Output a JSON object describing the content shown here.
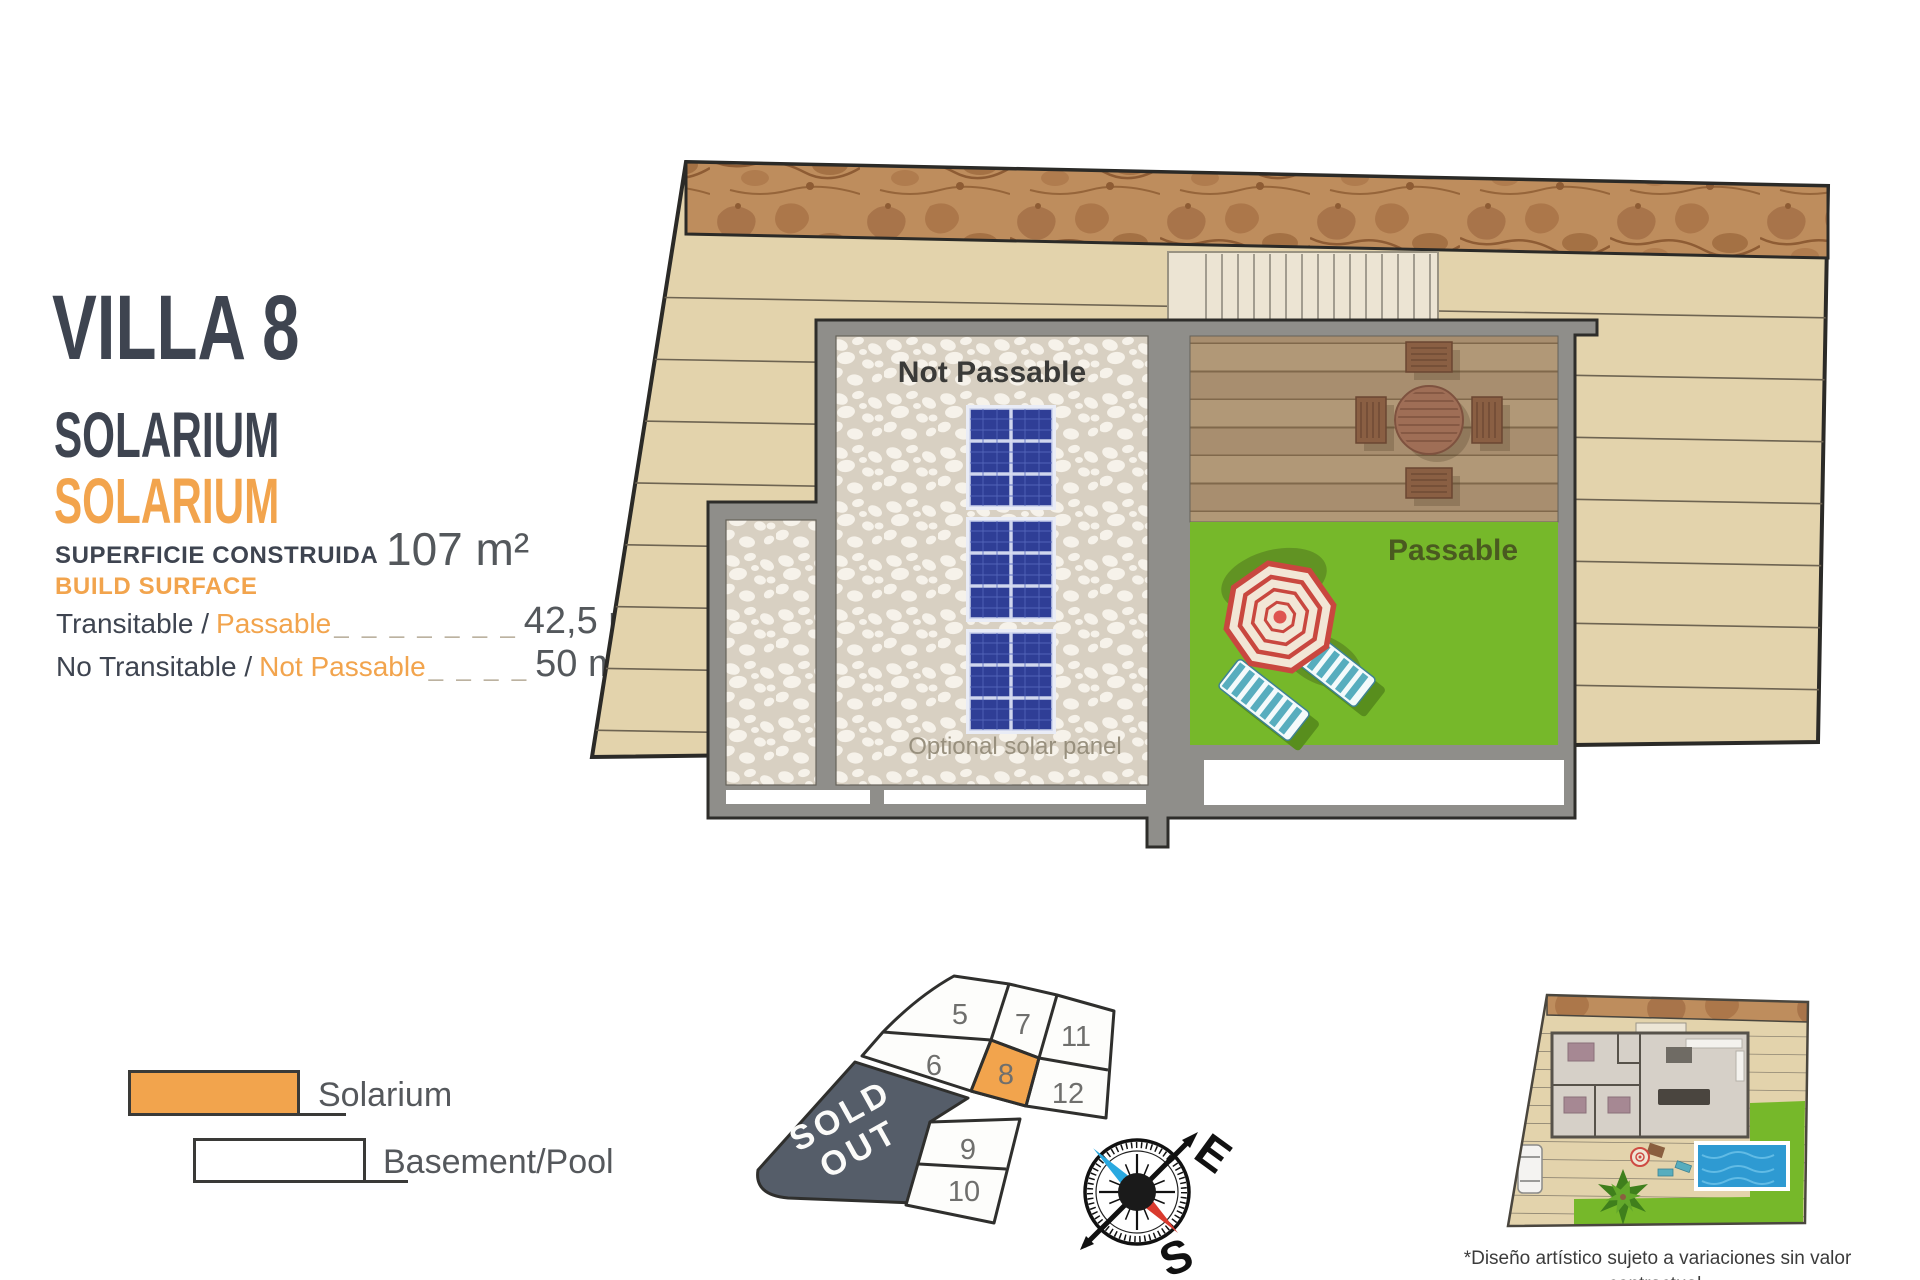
{
  "panel": {
    "title": "VILLA 8",
    "subtitle_primary": "SOLARIUM",
    "subtitle_secondary": "SOLARIUM",
    "surface_label_es": "SUPERFICIE CONSTRUIDA",
    "surface_label_en": "BUILD SURFACE",
    "surface_value": "107 m²",
    "rows": [
      {
        "label_es": "Transitable /",
        "label_en": "Passable",
        "dashes": "_ _ _ _ _ _ _",
        "value": "42,5 m²"
      },
      {
        "label_es": "No Transitable /",
        "label_en": "Not Passable",
        "dashes": "_ _ _ _",
        "value": "50 m²"
      }
    ]
  },
  "legend": {
    "items": [
      {
        "key": "solarium",
        "label": "Solarium"
      },
      {
        "key": "basement",
        "label": "Basement/Pool"
      }
    ]
  },
  "plan": {
    "not_passable_label": "Not Passable",
    "passable_label": "Passable",
    "solar_note": "Optional solar panel"
  },
  "plot_map": {
    "sold_out_line1": "SOLD",
    "sold_out_line2": "OUT",
    "highlighted_plot": "8",
    "plots": [
      {
        "id": "5"
      },
      {
        "id": "7"
      },
      {
        "id": "11"
      },
      {
        "id": "6"
      },
      {
        "id": "8"
      },
      {
        "id": "12"
      },
      {
        "id": "9"
      },
      {
        "id": "10"
      }
    ]
  },
  "compass": {
    "east": "E",
    "south": "S"
  },
  "footnote": {
    "line1": "*Diseño artístico sujeto a variaciones sin valor contractual.",
    "line2": "Muebles y paneles solares no incluidos"
  },
  "colors": {
    "accent_orange": "#F2A44D",
    "heading_dark": "#3E4450",
    "value_gray": "#54585C",
    "terrain_beige": "#E3D3AC",
    "rock_brown": "#BE8D5D",
    "pebble_bg": "#D8D0C2",
    "wall_gray": "#8F8E8A",
    "deck_wood": "#B19877",
    "lawn_green": "#76B82A",
    "solar_panel_blue": "#2F3E96",
    "sold_out_slate": "#555D69",
    "pool_blue": "#2E9AD2",
    "compass_needle_blue": "#2AA9E0",
    "compass_needle_red": "#D93A2E"
  }
}
